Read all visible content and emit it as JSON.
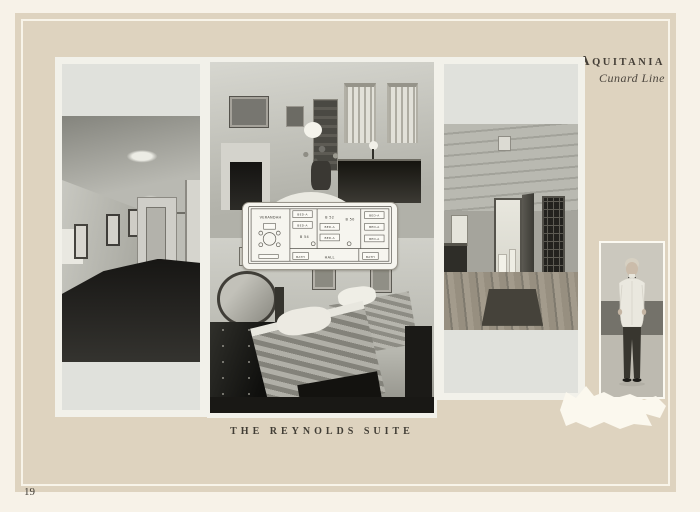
{
  "page": {
    "number": "19"
  },
  "header": {
    "ship_name": "AQUITANIA",
    "ship_initial": "A",
    "ship_rest": "QUITANIA",
    "line": "Cunard Line"
  },
  "caption": "THE REYNOLDS SUITE",
  "floor_plan": {
    "verandah": "VERANDAH",
    "room_b54": "B 54",
    "room_b52": "B 52",
    "room_b50": "B 50",
    "hall": "HALL",
    "bath": "BATH",
    "bed": "BED-A"
  },
  "colors": {
    "page_background": "#f7f2e8",
    "panel": "#ded3bf",
    "pinstripe": "#f8f4e9",
    "photo_mat": "#f2f1ea",
    "caption_text": "#413d35"
  }
}
